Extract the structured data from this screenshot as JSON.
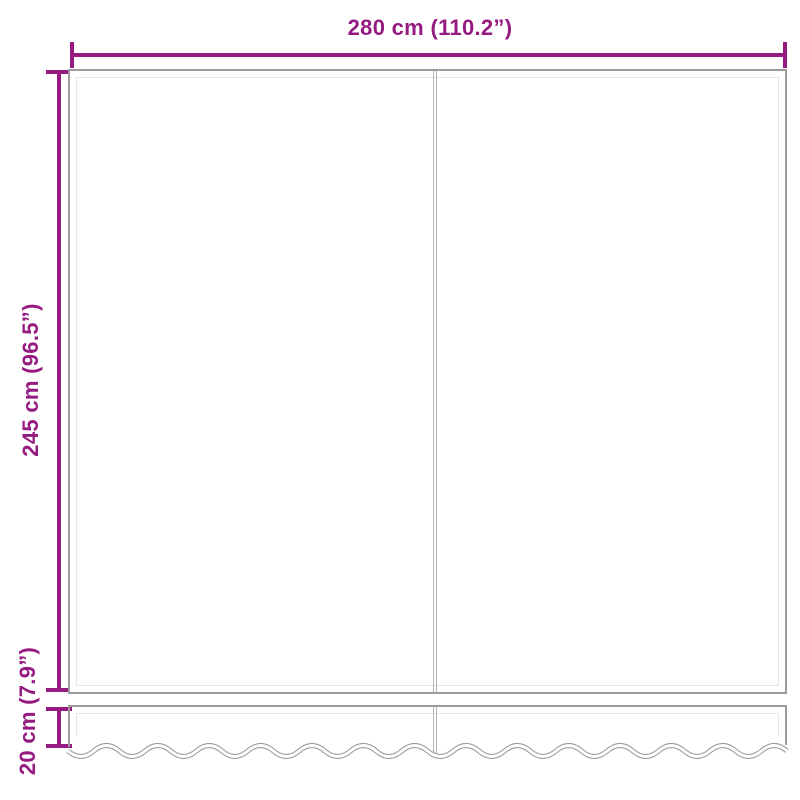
{
  "diagram": {
    "type": "product-dimension-diagram",
    "subject": "awning fabric panel with wavy valance",
    "colors": {
      "dimension_accent": "#951b81",
      "outline": "#9c9c9c",
      "outline_light": "#e6e6e6",
      "seam": "#b3b3b3",
      "background": "#ffffff"
    },
    "dimensions": {
      "width": {
        "label": "280 cm (110.2”)",
        "cm": 280,
        "inches": 110.2
      },
      "height": {
        "label": "245 cm (96.5”)",
        "cm": 245,
        "inches": 96.5
      },
      "valance": {
        "label": "20 cm (7.9”)",
        "cm": 20,
        "inches": 7.9
      }
    }
  }
}
